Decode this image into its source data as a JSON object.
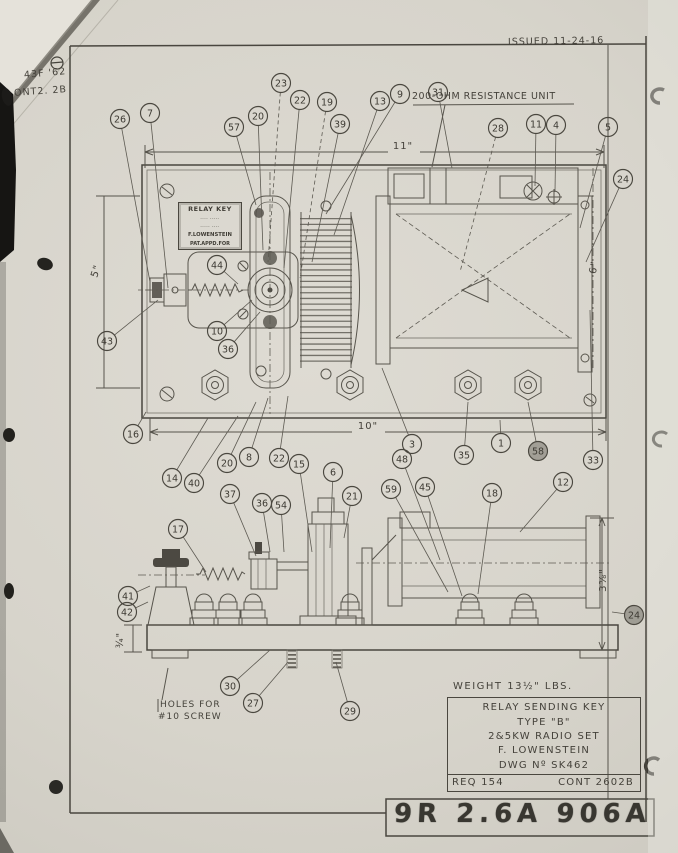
{
  "document": {
    "issued": "ISSUED  11-24-16",
    "corner_note_line1": "43F '62",
    "corner_note_line2": "ONT2. 2B",
    "stamp": "9R 2.6A 906A"
  },
  "labels": {
    "resistance_unit": "200-OHM RESISTANCE UNIT",
    "holes_line1": "HOLES FOR",
    "holes_line2": "#10 SCREW",
    "weight": "WEIGHT  13½\" LBS."
  },
  "nameplate": {
    "title": "RELAY KEY",
    "mid1": "‐‐‐‐  ‐‐‐‐‐",
    "mid2": "‐‐‐‐‐  ‐‐‐‐",
    "maker": "F.LOWENSTEIN",
    "patent": "PAT.APPD.FOR"
  },
  "title_block": {
    "row1": "RELAY SENDING KEY",
    "row2": "TYPE \"B\"",
    "row3": "2&5KW RADIO SET",
    "row4": "F. LOWENSTEIN",
    "row5": "DWG  Nº SK462",
    "req": "REQ 154",
    "cont": "CONT 2602B"
  },
  "dimensions": [
    {
      "text": "11\"",
      "x": 403,
      "y": 149,
      "rot": 0
    },
    {
      "text": "10\"",
      "x": 368,
      "y": 429,
      "rot": 0
    },
    {
      "text": "5\"",
      "x": 99,
      "y": 272,
      "rot": -72
    },
    {
      "text": "6\"",
      "x": 597,
      "y": 268,
      "rot": -78
    },
    {
      "text": "3⅝\"",
      "x": 606,
      "y": 580,
      "rot": -90
    },
    {
      "text": "¾\"",
      "x": 123,
      "y": 640,
      "rot": -90
    }
  ],
  "callouts": [
    {
      "n": "26",
      "x": 120,
      "y": 119,
      "tx": 150,
      "ty": 282
    },
    {
      "n": "7",
      "x": 150,
      "y": 113,
      "tx": 168,
      "ty": 288
    },
    {
      "n": "57",
      "x": 234,
      "y": 127,
      "tx": 256,
      "ty": 205
    },
    {
      "n": "20",
      "x": 258,
      "y": 116,
      "tx": 263,
      "ty": 250
    },
    {
      "n": "23",
      "x": 281,
      "y": 83,
      "tx": 268,
      "ty": 262,
      "dash": true
    },
    {
      "n": "22",
      "x": 300,
      "y": 100,
      "tx": 284,
      "ty": 268
    },
    {
      "n": "19",
      "x": 327,
      "y": 102,
      "tx": 300,
      "ty": 278,
      "dash": true
    },
    {
      "n": "39",
      "x": 340,
      "y": 124,
      "tx": 312,
      "ty": 262
    },
    {
      "n": "13",
      "x": 380,
      "y": 101,
      "tx": 334,
      "ty": 235
    },
    {
      "n": "9",
      "x": 400,
      "y": 94,
      "tx": 326,
      "ty": 214
    },
    {
      "n": "31",
      "x": 438,
      "y": 92,
      "tx": 452,
      "ty": 168
    },
    {
      "n": "28",
      "x": 498,
      "y": 128,
      "tx": 460,
      "ty": 272,
      "dash": true
    },
    {
      "n": "11",
      "x": 536,
      "y": 124,
      "tx": 535,
      "ty": 186
    },
    {
      "n": "4",
      "x": 556,
      "y": 125,
      "tx": 555,
      "ty": 192
    },
    {
      "n": "5",
      "x": 608,
      "y": 127,
      "tx": 580,
      "ty": 228
    },
    {
      "n": "24",
      "x": 623,
      "y": 179,
      "tx": 586,
      "ty": 262
    },
    {
      "n": "44",
      "x": 217,
      "y": 265,
      "tx": 238,
      "ty": 284
    },
    {
      "n": "43",
      "x": 107,
      "y": 341,
      "tx": 158,
      "ty": 300
    },
    {
      "n": "10",
      "x": 217,
      "y": 331,
      "tx": 252,
      "ty": 300
    },
    {
      "n": "36",
      "x": 228,
      "y": 349,
      "tx": 260,
      "ty": 312
    },
    {
      "n": "16",
      "x": 133,
      "y": 434,
      "tx": 146,
      "ty": 412
    },
    {
      "n": "14",
      "x": 172,
      "y": 478,
      "tx": 208,
      "ty": 418
    },
    {
      "n": "40",
      "x": 194,
      "y": 483,
      "tx": 238,
      "ty": 416
    },
    {
      "n": "20",
      "x": 227,
      "y": 463,
      "tx": 256,
      "ty": 402
    },
    {
      "n": "8",
      "x": 249,
      "y": 457,
      "tx": 268,
      "ty": 398
    },
    {
      "n": "22",
      "x": 279,
      "y": 458,
      "tx": 288,
      "ty": 396
    },
    {
      "n": "15",
      "x": 299,
      "y": 464,
      "tx": 312,
      "ty": 552
    },
    {
      "n": "6",
      "x": 333,
      "y": 472,
      "tx": 330,
      "ty": 548
    },
    {
      "n": "3",
      "x": 412,
      "y": 444,
      "tx": 382,
      "ty": 368
    },
    {
      "n": "48",
      "x": 402,
      "y": 459,
      "tx": 440,
      "ty": 560
    },
    {
      "n": "35",
      "x": 464,
      "y": 455,
      "tx": 468,
      "ty": 402
    },
    {
      "n": "1",
      "x": 501,
      "y": 443,
      "tx": 500,
      "ty": 420
    },
    {
      "n": "58",
      "x": 538,
      "y": 451,
      "tx": 528,
      "ty": 402,
      "smudge": true
    },
    {
      "n": "33",
      "x": 593,
      "y": 460,
      "tx": 590,
      "ty": 310
    },
    {
      "n": "59",
      "x": 391,
      "y": 489,
      "tx": 448,
      "ty": 592
    },
    {
      "n": "45",
      "x": 425,
      "y": 487,
      "tx": 462,
      "ty": 596
    },
    {
      "n": "18",
      "x": 492,
      "y": 493,
      "tx": 478,
      "ty": 594
    },
    {
      "n": "12",
      "x": 563,
      "y": 482,
      "tx": 520,
      "ty": 532
    },
    {
      "n": "17",
      "x": 178,
      "y": 529,
      "tx": 206,
      "ty": 572
    },
    {
      "n": "37",
      "x": 230,
      "y": 494,
      "tx": 256,
      "ty": 556
    },
    {
      "n": "36",
      "x": 262,
      "y": 503,
      "tx": 270,
      "ty": 552
    },
    {
      "n": "54",
      "x": 281,
      "y": 505,
      "tx": 284,
      "ty": 552
    },
    {
      "n": "21",
      "x": 352,
      "y": 496,
      "tx": 344,
      "ty": 538
    },
    {
      "n": "41",
      "x": 128,
      "y": 596,
      "tx": 150,
      "ty": 586
    },
    {
      "n": "42",
      "x": 127,
      "y": 612,
      "tx": 148,
      "ty": 602
    },
    {
      "n": "24",
      "x": 634,
      "y": 615,
      "tx": 612,
      "ty": 612,
      "smudge": true
    },
    {
      "n": "30",
      "x": 230,
      "y": 686,
      "tx": 270,
      "ty": 650
    },
    {
      "n": "27",
      "x": 253,
      "y": 703,
      "tx": 288,
      "ty": 662
    },
    {
      "n": "29",
      "x": 350,
      "y": 711,
      "tx": 336,
      "ty": 662
    }
  ]
}
